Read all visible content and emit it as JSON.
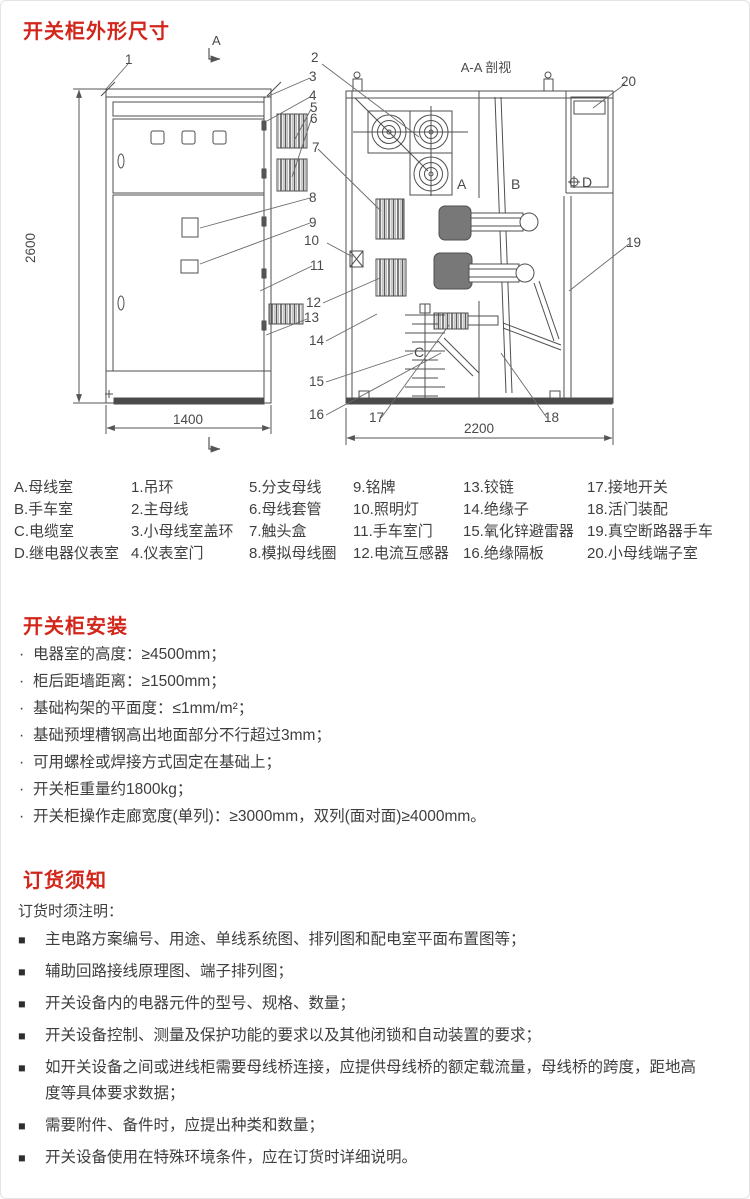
{
  "colors": {
    "accent": "#d2261b",
    "text": "#3e3e3e",
    "line": "#4f4f4f"
  },
  "dimensions_section": {
    "title": "开关柜外形尺寸"
  },
  "diagram": {
    "aa_label": "A-A 剖视",
    "marker_letter": "A",
    "dims": {
      "height": "2600",
      "width": "1400",
      "depth": "2200"
    },
    "compartments": {
      "a": "A",
      "b": "B",
      "c": "C",
      "d": "D"
    },
    "callouts": [
      "1",
      "2",
      "3",
      "4",
      "5",
      "6",
      "7",
      "8",
      "9",
      "10",
      "11",
      "12",
      "13",
      "14",
      "15",
      "16",
      "17",
      "18",
      "19",
      "20"
    ]
  },
  "legend": {
    "columns": [
      [
        "A.母线室",
        "B.手车室",
        "C.电缆室",
        "D.继电器仪表室"
      ],
      [
        "1.吊环",
        "2.主母线",
        "3.小母线室盖环",
        "4.仪表室门"
      ],
      [
        "5.分支母线",
        "6.母线套管",
        "7.触头盒",
        "8.模拟母线圈"
      ],
      [
        "9.铭牌",
        "10.照明灯",
        "11.手车室门",
        "12.电流互感器"
      ],
      [
        "13.铰链",
        "14.绝缘子",
        "15.氧化锌避雷器",
        "16.绝缘隔板"
      ],
      [
        "17.接地开关",
        "18.活门装配",
        "19.真空断路器手车",
        "20.小母线端子室"
      ]
    ]
  },
  "installation": {
    "title": "开关柜安装",
    "bullet": "·",
    "items": [
      "电器室的高度：≥4500mm；",
      "柜后距墙距离：≥1500mm；",
      "基础构架的平面度：≤1mm/m²；",
      "基础预埋槽钢高出地面部分不行超过3mm；",
      "可用螺栓或焊接方式固定在基础上；",
      "开关柜重量约1800kg；",
      "开关柜操作走廊宽度(单列)：≥3000mm，双列(面对面)≥4000mm。"
    ]
  },
  "ordering": {
    "title": "订货须知",
    "intro": "订货时须注明：",
    "bullet": "■",
    "items": [
      "主电路方案编号、用途、单线系统图、排列图和配电室平面布置图等；",
      "辅助回路接线原理图、端子排列图；",
      "开关设备内的电器元件的型号、规格、数量；",
      "开关设备控制、测量及保护功能的要求以及其他闭锁和自动装置的要求；",
      "如开关设备之间或进线柜需要母线桥连接，应提供母线桥的额定载流量，母线桥的跨度，距地高度等具体要求数据；",
      "需要附件、备件时，应提出种类和数量；",
      "开关设备使用在特殊环境条件，应在订货时详细说明。"
    ]
  }
}
